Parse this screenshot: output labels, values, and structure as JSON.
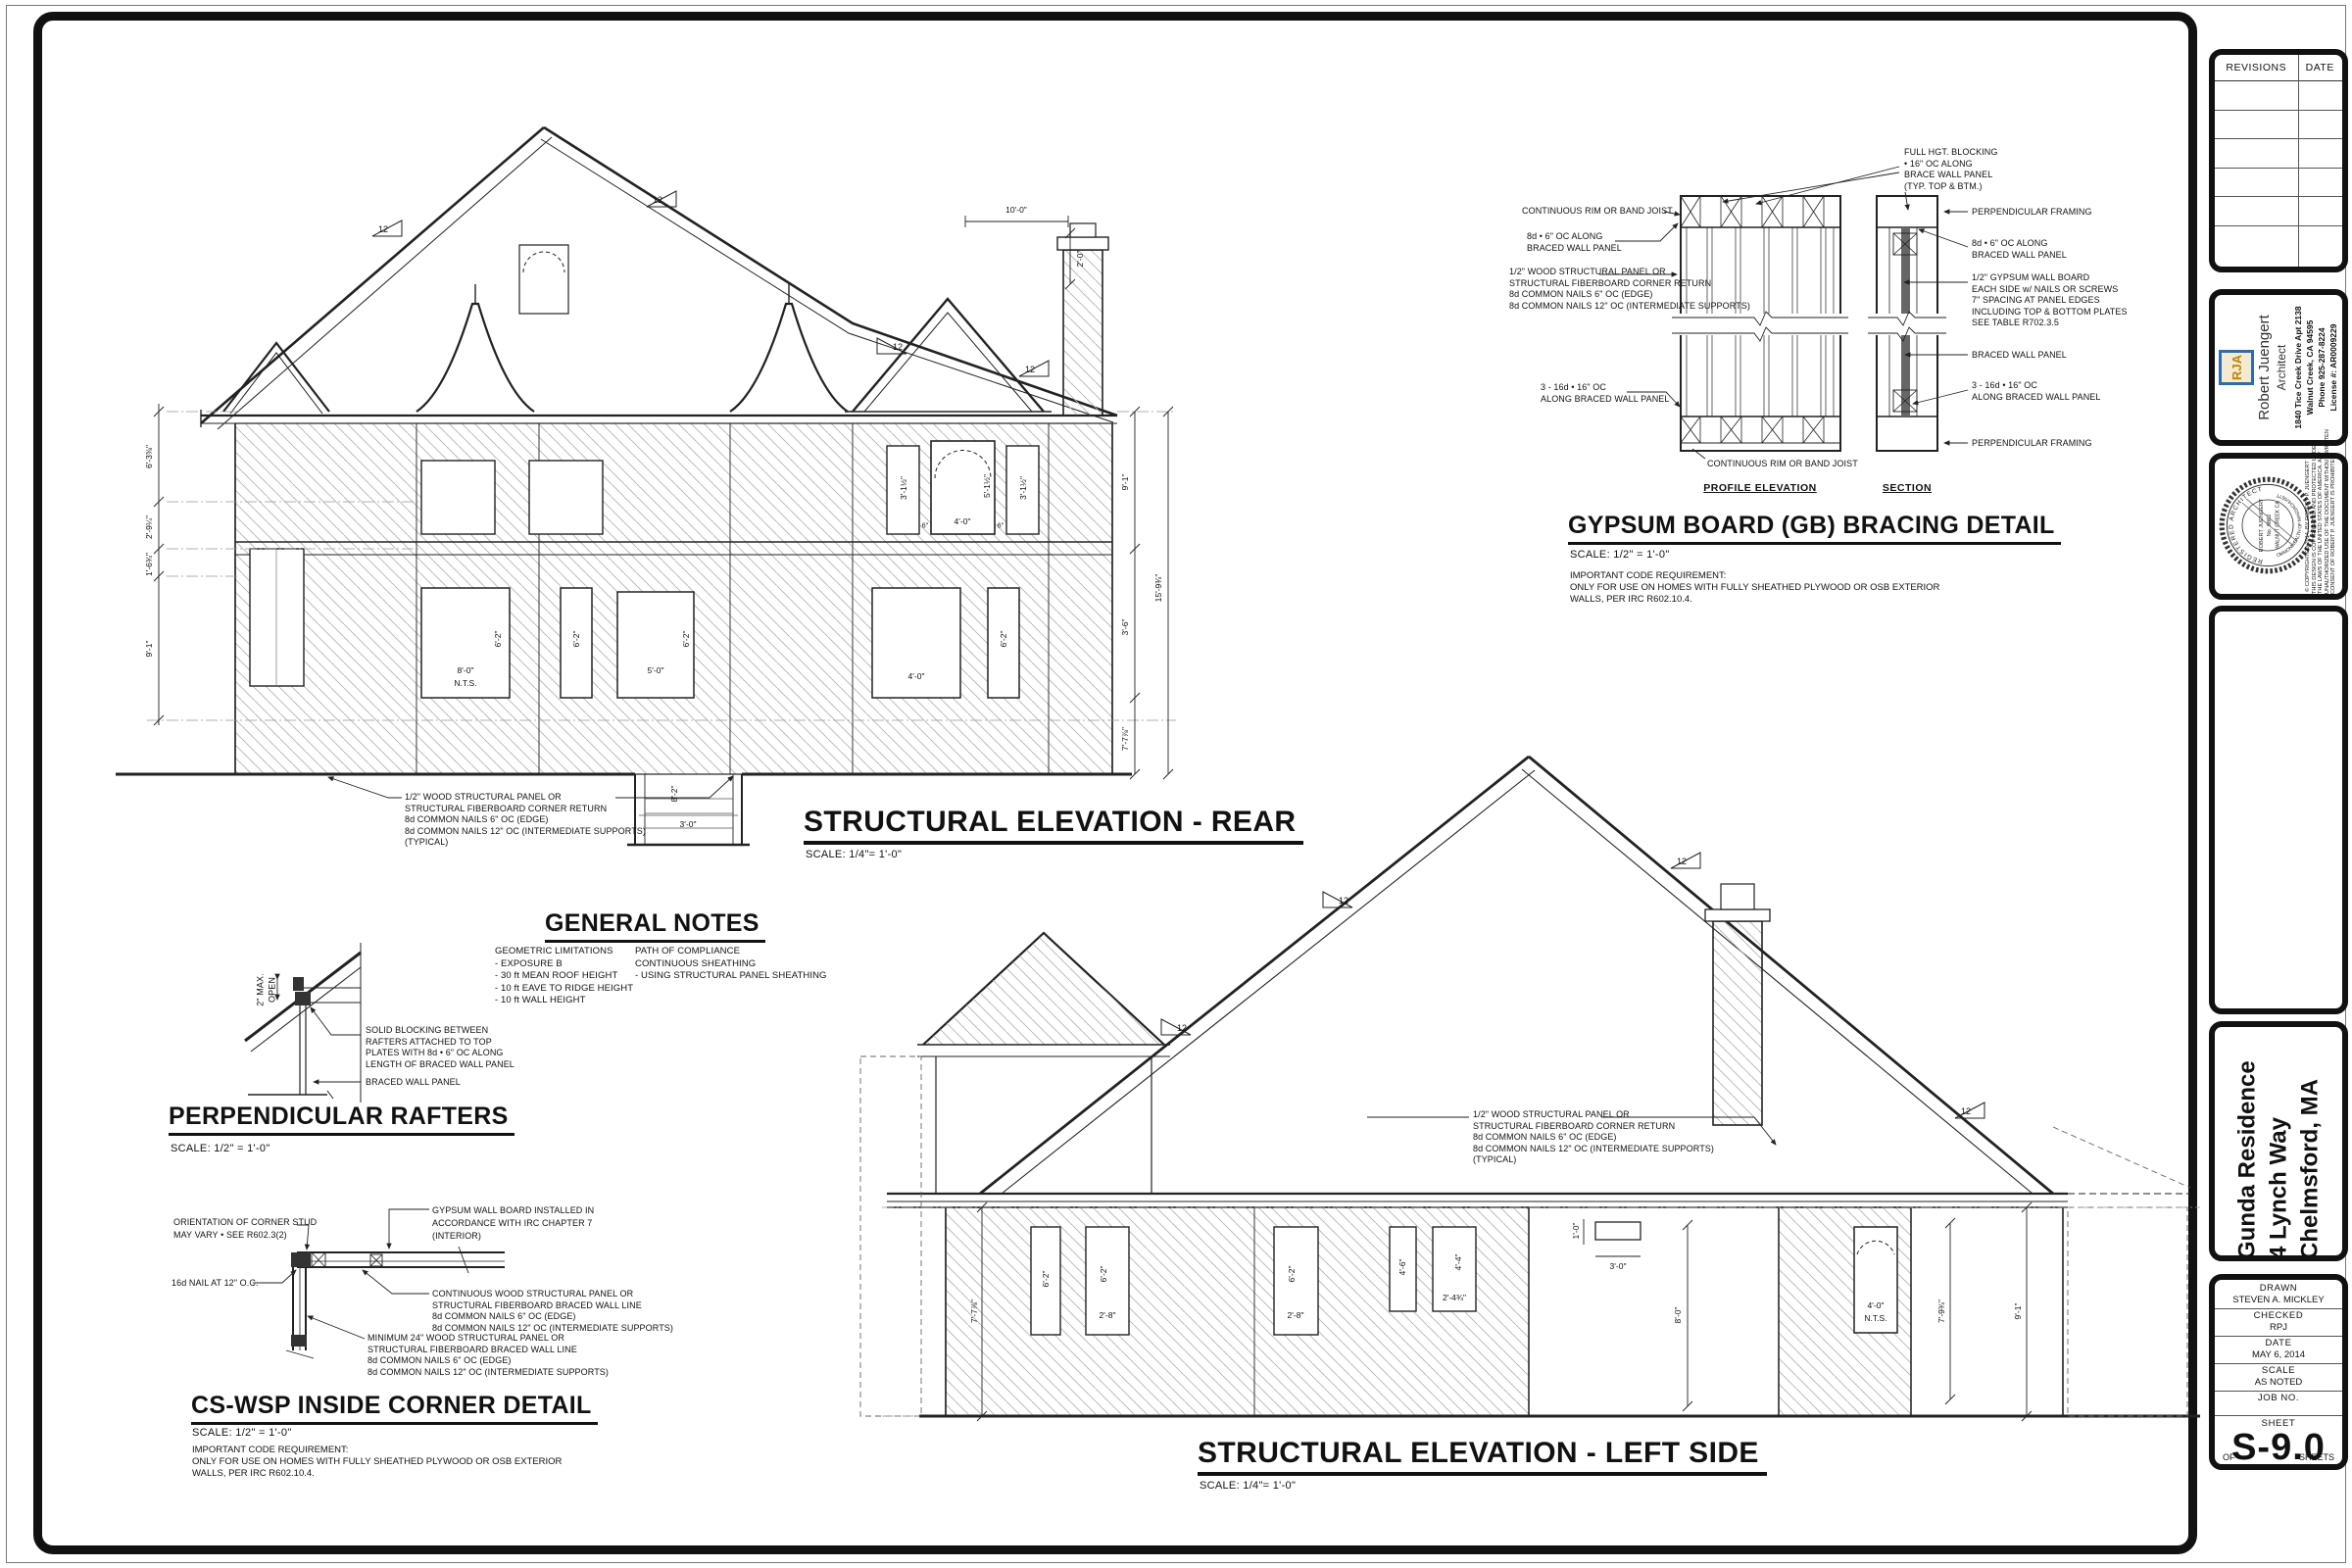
{
  "shared": {
    "pitch": "12",
    "corner_note": [
      "1/2\" WOOD STRUCTURAL PANEL OR",
      "STRUCTURAL FIBERBOARD CORNER RETURN",
      "8d COMMON NAILS 6\" OC (EDGE)",
      "8d COMMON NAILS 12\" OC (INTERMEDIATE SUPPORTS)",
      "(TYPICAL)"
    ],
    "code_note": [
      "IMPORTANT CODE REQUIREMENT:",
      "ONLY FOR USE ON HOMES WITH FULLY SHEATHED PLYWOOD OR OSB EXTERIOR",
      "WALLS, PER IRC R602.10.4."
    ]
  },
  "rear": {
    "title": "STRUCTURAL ELEVATION - REAR",
    "scale": "SCALE:  1/4\"= 1'-0\"",
    "dims_left": [
      "6'-3⅜\"",
      "2'-9¼\"",
      "1'-6¾\"",
      "9'-1\""
    ],
    "dims_right": [
      "9'-1\"",
      "3'-6\"",
      "7'-7⅞\"",
      "15'-9¾\""
    ],
    "dims_top": [
      "10'-0\"",
      "2'-0\""
    ],
    "stairwell": {
      "w": "3'-0\"",
      "h": "8'-2\""
    },
    "win": {
      "w1": "8'-0\"",
      "nts": "N.T.S.",
      "h62": "6'-2\"",
      "w3": "5'-0\"",
      "w4": "4'-0\"",
      "arch_w": "4'-0\"",
      "arch_h": "5'-1½\"",
      "side": "3'-1½\"",
      "gap": "6\""
    }
  },
  "left": {
    "title": "STRUCTURAL ELEVATION - LEFT SIDE",
    "scale": "SCALE:  1/4\"= 1'-0\"",
    "dims": [
      "7'-7⅞\"",
      "8'-0\"",
      "7'-9¾\"",
      "9'-1\""
    ],
    "vent": {
      "h": "1'-0\"",
      "w": "3'-0\""
    },
    "win": {
      "h62": "6'-2\"",
      "w28": "2'-8\"",
      "h46": "4'-6\"",
      "w44": "4'-4\"",
      "w24": "2'-4¾\"",
      "arch": "4'-0\"",
      "nts": "N.T.S."
    }
  },
  "gb": {
    "title": "GYPSUM BOARD (GB) BRACING DETAIL",
    "scale": "SCALE: 1/2\" = 1'-0\"",
    "profile_label": "PROFILE ELEVATION",
    "section_label": "SECTION",
    "ann_top": [
      "FULL HGT. BLOCKING",
      "• 16\" OC ALONG",
      "BRACE WALL PANEL",
      "(TYP. TOP & BTM.)"
    ],
    "ann_left_1": "CONTINUOUS RIM OR BAND JOIST",
    "ann_left_2": [
      "8d • 6\" OC ALONG",
      "BRACED WALL PANEL"
    ],
    "ann_left_3": [
      "1/2\" WOOD STRUCTURAL PANEL OR",
      "STRUCTURAL FIBERBOARD CORNER RETURN",
      "8d COMMON NAILS 6\" OC (EDGE)",
      "8d COMMON NAILS 12\" OC (INTERMEDIATE SUPPORTS)"
    ],
    "ann_left_4": [
      "3 - 16d • 16\" OC",
      "ALONG BRACED WALL PANEL"
    ],
    "ann_left_5": "CONTINUOUS RIM OR BAND JOIST",
    "ann_right_1": "PERPENDICULAR FRAMING",
    "ann_right_2": [
      "8d • 6\" OC ALONG",
      "BRACED WALL PANEL"
    ],
    "ann_right_3": [
      "1/2\" GYPSUM WALL BOARD",
      "EACH SIDE w/ NAILS OR SCREWS",
      "7\" SPACING AT PANEL EDGES",
      "INCLUDING TOP & BOTTOM PLATES",
      "SEE TABLE R702.3.5"
    ],
    "ann_right_4": "BRACED WALL PANEL",
    "ann_right_5": [
      "3 - 16d • 16\" OC",
      "ALONG BRACED WALL PANEL"
    ],
    "ann_right_6": "PERPENDICULAR FRAMING"
  },
  "perp": {
    "title": "PERPENDICULAR RAFTERS",
    "scale": "SCALE: 1/2\" = 1'-0\"",
    "blocking": [
      "SOLID BLOCKING BETWEEN",
      "RAFTERS ATTACHED TO TOP",
      "PLATES WITH 8d • 6\" OC ALONG",
      "LENGTH OF BRACED WALL PANEL"
    ],
    "braced": "BRACED WALL PANEL",
    "max_open": [
      "2\" MAX.",
      "OPEN"
    ]
  },
  "cswsp": {
    "title": "CS-WSP INSIDE CORNER DETAIL",
    "scale": "SCALE: 1/2\" = 1'-0\"",
    "orientation": [
      "ORIENTATION OF CORNER STUD",
      "MAY VARY • SEE R602.3(2)"
    ],
    "nail": "16d NAIL AT 12\" O.C.",
    "gwb": [
      "GYPSUM WALL BOARD INSTALLED IN",
      "ACCORDANCE WITH IRC CHAPTER 7",
      "(INTERIOR)"
    ],
    "continuous": [
      "CONTINUOUS WOOD STRUCTURAL PANEL OR",
      "STRUCTURAL FIBERBOARD BRACED WALL LINE",
      "8d COMMON NAILS 6\" OC (EDGE)",
      "8d COMMON NAILS 12\" OC (INTERMEDIATE SUPPORTS)"
    ],
    "minimum": [
      "MINIMUM 24\" WOOD STRUCTURAL PANEL OR",
      "STRUCTURAL FIBERBOARD BRACED WALL LINE",
      "8d COMMON NAILS 6\" OC (EDGE)",
      "8d COMMON NAILS 12\" OC (INTERMEDIATE SUPPORTS)"
    ]
  },
  "notes": {
    "title": "GENERAL NOTES",
    "col1": [
      "GEOMETRIC LIMITATIONS",
      "- EXPOSURE B",
      "- 30 ft MEAN ROOF HEIGHT",
      "- 10 ft EAVE TO RIDGE HEIGHT",
      "- 10 ft WALL HEIGHT"
    ],
    "col2": [
      "PATH OF COMPLIANCE",
      "CONTINUOUS SHEATHING",
      "- USING STRUCTURAL PANEL SHEATHING"
    ]
  },
  "tb": {
    "revisions_header": "REVISIONS",
    "date_header": "DATE",
    "architect": {
      "logo_text": "RJA",
      "name": "Robert Juengert",
      "role": "Architect",
      "address": "1840 Tice Creek Drive Apt 2138",
      "city": "Walnut Creek, CA 94595",
      "phone": "Phone 925-287-8224",
      "license": "License #: AR0009229"
    },
    "seal": {
      "arc_top": "REGISTERED ARCHITECT",
      "name": "ROBERT JUENGERT",
      "no": "No. 9862",
      "city": "WALNUT CREEK CA",
      "arc_bottom": "COMMONWEALTH OF MASSACHUSETTS"
    },
    "copyright": [
      "© COPYRIGHTED 2014, BY ROBERT P. JUENGERT",
      "THIS DESIGN IS COPYRIGHTED AND PROTECTED UNDER",
      "THE LAWS OF THE UNITED STATES OF AMERICA.  ANY",
      "UNAUTHORIZED USE OF THE DOCUMENT WITHOUT WRITTEN",
      "CONSENT OF ROBERT P. JUENGERT IS PROHIBITED."
    ],
    "project": {
      "name": "Gunda Residence",
      "address": "4 Lynch Way",
      "city": "Chelmsford, MA"
    },
    "info": {
      "drawn_label": "DRAWN",
      "drawn": "STEVEN A. MICKLEY",
      "checked_label": "CHECKED",
      "checked": "RPJ",
      "date_label": "DATE",
      "date": "MAY 6, 2014",
      "scale_label": "SCALE",
      "scale": "AS NOTED",
      "job_label": "JOB NO.",
      "sheet_label": "SHEET",
      "sheet_no": "S-9.0",
      "of_label": "OF",
      "sheets_label": "SHEETS"
    }
  }
}
